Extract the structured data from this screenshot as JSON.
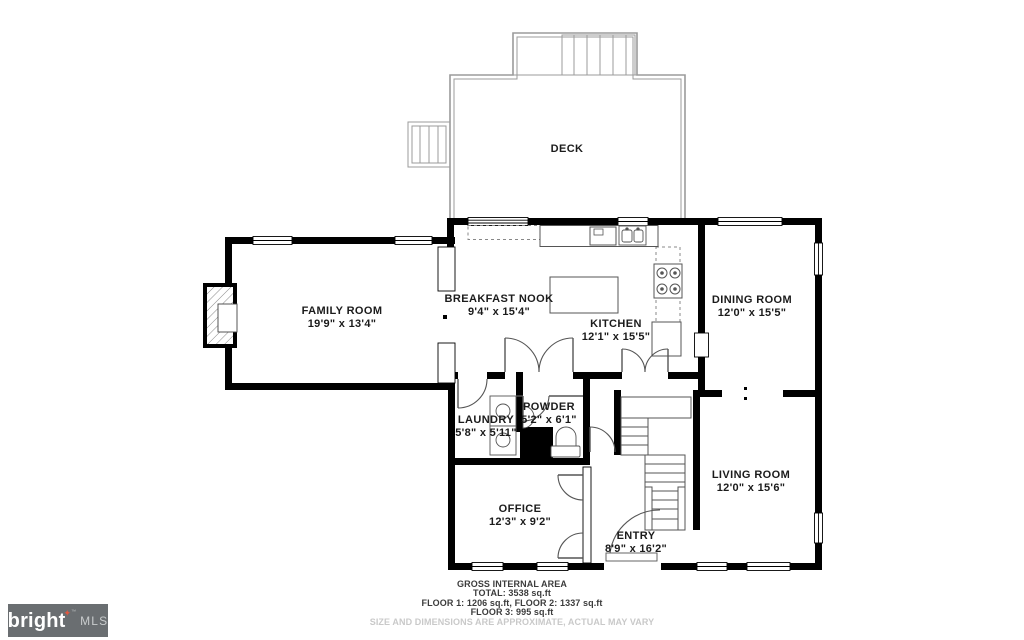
{
  "rooms": [
    {
      "name": "DECK",
      "dims": ""
    },
    {
      "name": "FAMILY ROOM",
      "dims": "19'9\" x 13'4\""
    },
    {
      "name": "BREAKFAST NOOK",
      "dims": "9'4\" x 15'4\""
    },
    {
      "name": "KITCHEN",
      "dims": "12'1\" x 15'5\""
    },
    {
      "name": "DINING ROOM",
      "dims": "12'0\" x 15'5\""
    },
    {
      "name": "LAUNDRY",
      "dims": "5'8\" x 5'11\""
    },
    {
      "name": "POWDER",
      "dims": "5'2\" x 6'1\""
    },
    {
      "name": "OFFICE",
      "dims": "12'3\" x 9'2\""
    },
    {
      "name": "ENTRY",
      "dims": "8'9\" x 16'2\""
    },
    {
      "name": "LIVING ROOM",
      "dims": "12'0\" x 15'6\""
    }
  ],
  "footer": {
    "line1": "GROSS INTERNAL AREA",
    "line2": "TOTAL: 3538 sq.ft",
    "line3": "FLOOR 1: 1206 sq.ft, FLOOR 2: 1337 sq.ft",
    "line4": "FLOOR 3: 995 sq.ft",
    "disclaimer": "SIZE AND DIMENSIONS ARE APPROXIMATE, ACTUAL MAY VARY"
  },
  "logo": {
    "brand": "bright",
    "star": "✦",
    "tm": "™",
    "suffix": "MLS"
  },
  "colors": {
    "wall": "#000000",
    "deck_line": "#9b9b9b",
    "fixture_line": "#555555",
    "label_text": "#1b1b1b",
    "disclaimer_text": "#c9c9c9",
    "logo_bg": "#6a6e71",
    "logo_star": "#e2573f"
  }
}
